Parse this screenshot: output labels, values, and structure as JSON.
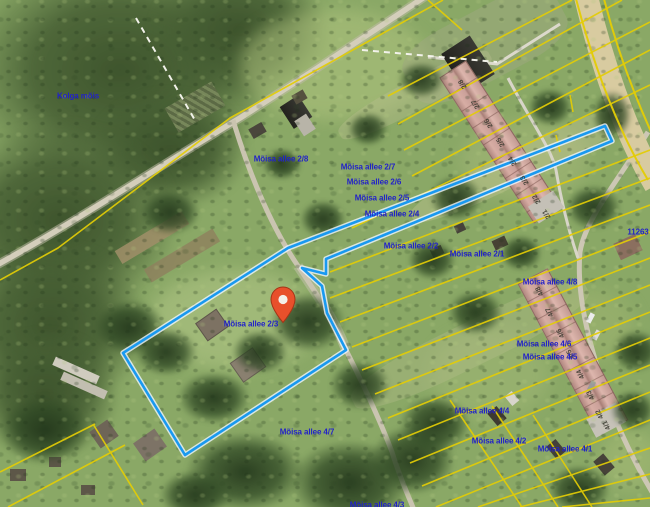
{
  "map": {
    "highlighted_parcel": "Mõisa allee 2/3",
    "marker": {
      "x": 283,
      "y": 323,
      "parcel": "Mõisa allee 2/3"
    },
    "blue_labels": [
      {
        "t": "Kolga mõis",
        "x": 78,
        "y": 96
      },
      {
        "t": "Mõisa allee 2/8",
        "x": 281,
        "y": 159
      },
      {
        "t": "Mõisa allee 2/7",
        "x": 368,
        "y": 167
      },
      {
        "t": "Mõisa allee 2/6",
        "x": 374,
        "y": 182
      },
      {
        "t": "Mõisa allee 2/5",
        "x": 382,
        "y": 198
      },
      {
        "t": "Mõisa allee 2/4",
        "x": 392,
        "y": 214
      },
      {
        "t": "Mõisa allee 2/2",
        "x": 411,
        "y": 246
      },
      {
        "t": "Mõisa allee 2/1",
        "x": 477,
        "y": 254
      },
      {
        "t": "Mõisa allee 4/8",
        "x": 550,
        "y": 282
      },
      {
        "t": "Mõisa allee 4/6",
        "x": 544,
        "y": 344
      },
      {
        "t": "Mõisa allee 4/5",
        "x": 550,
        "y": 357
      },
      {
        "t": "Mõisa allee 4/4",
        "x": 482,
        "y": 411
      },
      {
        "t": "Mõisa allee 4/2",
        "x": 499,
        "y": 441
      },
      {
        "t": "Mõisa allee 4/1",
        "x": 565,
        "y": 449
      },
      {
        "t": "Mõisa allee 2/3",
        "x": 251,
        "y": 324
      },
      {
        "t": "Mõisa allee 4/7",
        "x": 307,
        "y": 432
      },
      {
        "t": "Mõisa allee 4/3",
        "x": 377,
        "y": 505
      },
      {
        "t": "11263",
        "x": 638,
        "y": 232
      }
    ],
    "roof_labels_north": [
      {
        "t": "2/8",
        "x": 463,
        "y": 84,
        "rot": -123
      },
      {
        "t": "2/7",
        "x": 476,
        "y": 104,
        "rot": -123
      },
      {
        "t": "2/6",
        "x": 489,
        "y": 123,
        "rot": -123
      },
      {
        "t": "2/5",
        "x": 501,
        "y": 142,
        "rot": -123
      },
      {
        "t": "2/4",
        "x": 513,
        "y": 161,
        "rot": -123
      },
      {
        "t": "2/3",
        "x": 525,
        "y": 180,
        "rot": -123
      },
      {
        "t": "2/2",
        "x": 537,
        "y": 199,
        "rot": -123
      },
      {
        "t": "2/1",
        "x": 547,
        "y": 214,
        "rot": -123
      }
    ],
    "roof_labels_east": [
      {
        "t": "4/8",
        "x": 540,
        "y": 291,
        "rot": -118
      },
      {
        "t": "4/7",
        "x": 550,
        "y": 312,
        "rot": -118
      },
      {
        "t": "4/6",
        "x": 561,
        "y": 333,
        "rot": -118
      },
      {
        "t": "4/5",
        "x": 571,
        "y": 354,
        "rot": -118
      },
      {
        "t": "4/4",
        "x": 581,
        "y": 374,
        "rot": -118
      },
      {
        "t": "4/3",
        "x": 591,
        "y": 395,
        "rot": -118
      },
      {
        "t": "4/2",
        "x": 600,
        "y": 414,
        "rot": -118
      },
      {
        "t": "4/1",
        "x": 607,
        "y": 425,
        "rot": -118
      }
    ],
    "colors": {
      "parcel_highlight": "#1999f0",
      "cadastral_line": "#e4cd05",
      "label_text": "#2222c8",
      "marker_fill": "#e8502b",
      "road_fill": "#d8cba0"
    }
  }
}
